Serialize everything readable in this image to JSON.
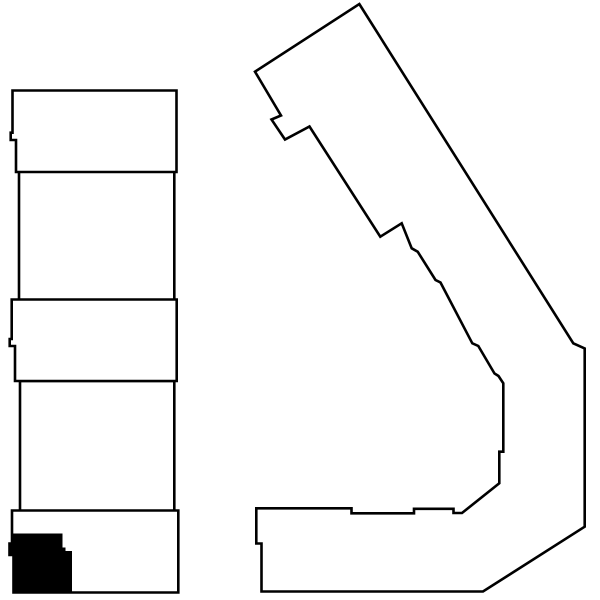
{
  "canvas": {
    "width": 600,
    "height": 600,
    "viewbox": "0 0 600 600",
    "background_color": "#ffffff",
    "outline_color": "#000000",
    "fill_color": "#ffffff",
    "highlight_color": "#000000",
    "stroke_width": 2.6
  },
  "diagram": {
    "description": "floor-plan outlines of two buildings, one unit filled black",
    "shapes": [
      {
        "name": "left-building-section-2",
        "interactable": false,
        "fill": "#ffffff",
        "stroke": "#000000",
        "stroke_width": 2.6,
        "points": "19,171 174.3,171 174.3,300.5 19,300.5"
      },
      {
        "name": "left-building-section-4",
        "interactable": false,
        "fill": "#ffffff",
        "stroke": "#000000",
        "stroke_width": 2.6,
        "points": "20,381 174.3,381 174.3,511.5 20,511.5"
      },
      {
        "name": "left-building-section-1",
        "interactable": false,
        "fill": "#ffffff",
        "stroke": "#000000",
        "stroke_width": 2.6,
        "points": "12.5,90.5 176.5,90.5 176.5,172 16,172 16,140 10.7,140 10.7,132.7 12.5,132.7"
      },
      {
        "name": "left-building-section-3",
        "interactable": false,
        "fill": "#ffffff",
        "stroke": "#000000",
        "stroke_width": 2.6,
        "points": "11.7,299.5 176.7,299.5 176.7,381 15,381 15,346 9.7,346 9.7,339 11.7,339"
      },
      {
        "name": "left-building-section-5",
        "interactable": false,
        "fill": "#ffffff",
        "stroke": "#000000",
        "stroke_width": 2.6,
        "points": "12,510.5 178.3,510.5 178.3,592.5 13.5,592.5 13.5,555 9.5,555 9.5,543.5 12,543.5"
      },
      {
        "name": "highlighted-unit",
        "interactable": true,
        "fill": "#000000",
        "stroke": "#000000",
        "stroke_width": 2,
        "points": "12,534.5 61.5,534.5 61.5,548.5 64.5,548.5 64.5,552 71,552 71,592.5 13.5,592.5 13.5,555 9.5,555 9.5,543.5 12,543.5"
      },
      {
        "name": "right-building-outline",
        "interactable": false,
        "fill": "#ffffff",
        "stroke": "#000000",
        "stroke_width": 2.6,
        "points": "359.3,4 573.3,343.3 584.7,348.5 584.7,526.7 483,591.5 261.5,591.5 261.5,543.5 256.3,543.5 256.3,508.3 351.5,508.3 351.5,513.3 414,513.3 414,508.8 453.5,508.8 453.5,513 462,513 499.3,483.3 499.3,451.7 503.3,451.7 503.3,383.3 498.5,376 494.5,373.5 478.3,346 472.3,343.3 440.5,282.5 435.5,280 417.7,251.7 411.7,248.3 401.7,223.3 380.3,236.7 309.5,126.5 285,139.5 271.5,119.5 281,115.5 255,71.7"
      }
    ]
  }
}
